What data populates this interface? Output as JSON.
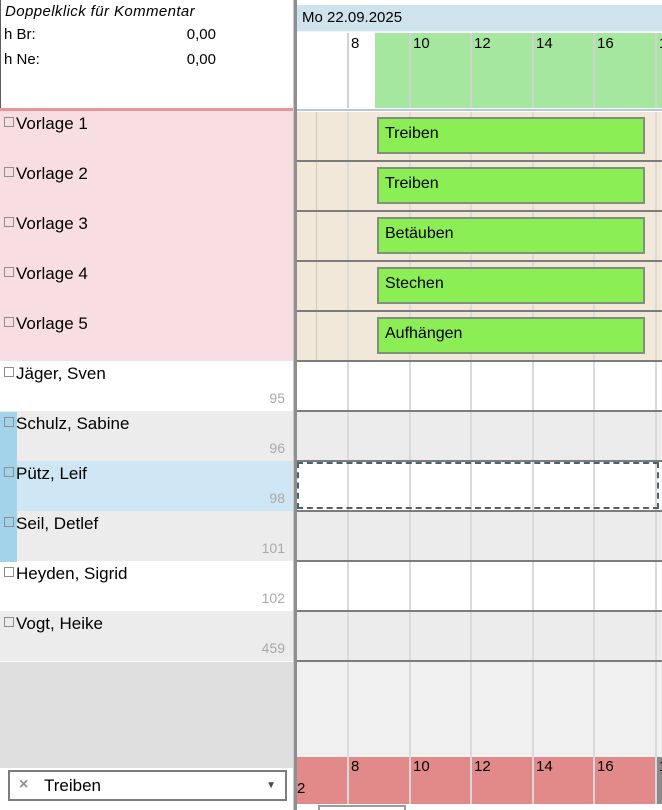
{
  "info_panel": {
    "title": "Doppelklick für Kommentar",
    "fields": [
      {
        "label": "h Br:",
        "value": "0,00"
      },
      {
        "label": "h Ne:",
        "value": "0,00"
      }
    ]
  },
  "header": {
    "date": "Mo 22.09.2025"
  },
  "timeline": {
    "ticks": [
      {
        "label": "6",
        "x": -12
      },
      {
        "label": "8",
        "x": 50
      },
      {
        "label": "10",
        "x": 112
      },
      {
        "label": "12",
        "x": 173
      },
      {
        "label": "14",
        "x": 235
      },
      {
        "label": "16",
        "x": 296
      },
      {
        "label": "18",
        "x": 358
      }
    ],
    "highlight_start_x": 78,
    "bar_x": 80,
    "bar_w": 268,
    "beige_extra_line_x": 19,
    "stray_label": "2"
  },
  "rows": [
    {
      "label": "Vorlage 1",
      "type": "template",
      "bar": "Treiben"
    },
    {
      "label": "Vorlage 2",
      "type": "template",
      "bar": "Treiben"
    },
    {
      "label": "Vorlage 3",
      "type": "template",
      "bar": "Betäuben"
    },
    {
      "label": "Vorlage 4",
      "type": "template",
      "bar": "Stechen"
    },
    {
      "label": "Vorlage 5",
      "type": "template",
      "bar": "Aufhängen"
    },
    {
      "label": "Jäger, Sven",
      "number": "95",
      "type": "person",
      "alt": false,
      "strip": false,
      "selected": false
    },
    {
      "label": "Schulz, Sabine",
      "number": "96",
      "type": "person",
      "alt": true,
      "strip": true,
      "selected": false
    },
    {
      "label": "Pütz, Leif",
      "number": "98",
      "type": "person",
      "alt": false,
      "strip": true,
      "selected": true
    },
    {
      "label": "Seil, Detlef",
      "number": "101",
      "type": "person",
      "alt": true,
      "strip": true,
      "selected": false
    },
    {
      "label": "Heyden, Sigrid",
      "number": "102",
      "type": "person",
      "alt": false,
      "strip": false,
      "selected": false
    },
    {
      "label": "Vogt, Heike",
      "number": "459",
      "type": "person",
      "alt": true,
      "strip": false,
      "selected": false
    }
  ],
  "footer": {
    "combo_value": "Treiben",
    "clear_icon": "×",
    "dropdown_icon": "▼"
  },
  "colors": {
    "header_blue": "#cfe3ed",
    "ruler_green": "#a5e79e",
    "bar_green": "#8cee55",
    "bar_border": "#7e917c",
    "template_pink": "#f8dee3",
    "row_beige": "#f2e8da",
    "row_alt_gray": "#ececec",
    "selected_blue": "#cfe6f4",
    "marker_blue_strip": "#a3d3eb",
    "bottom_red": "#e2898a",
    "divider_red": "#e69598",
    "number_gray": "#a9a9a9"
  }
}
